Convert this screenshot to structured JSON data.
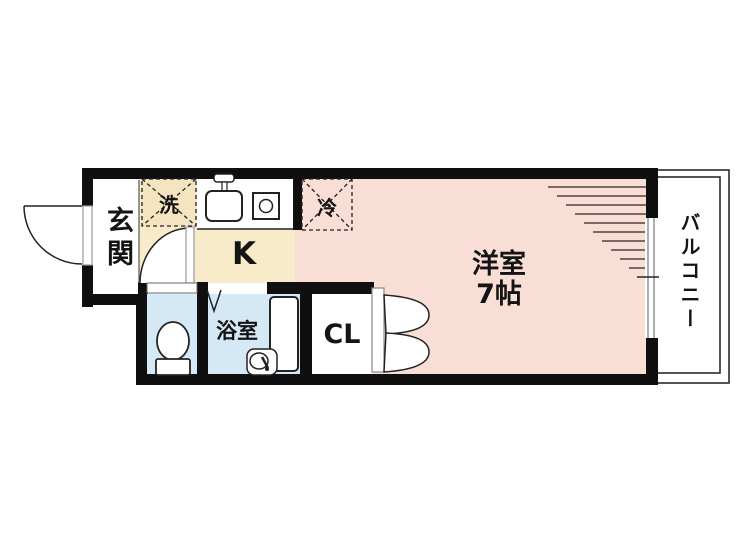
{
  "plan": {
    "type": "apartment-floor-plan",
    "rooms": {
      "genkan": {
        "label": "玄関"
      },
      "kitchen": {
        "label": "K"
      },
      "washer_box": {
        "label": "洗"
      },
      "fridge_box": {
        "label": "冷"
      },
      "bathroom": {
        "label": "浴室"
      },
      "western_room": {
        "label": "洋室",
        "size": "7帖"
      },
      "closet": {
        "label": "CL"
      },
      "balcony": {
        "label": "バルコニー"
      }
    },
    "icons": {
      "toilet": "toilet-icon",
      "bathtub": "bathtub-icon",
      "bath_faucet": "faucet-icon",
      "kitchen_sink": "sink-icon",
      "stove": "stove-burner-icon"
    },
    "colors": {
      "room_pink": "#f9ded5",
      "kitchen_cream": "#f8ebc9",
      "wet_blue": "#d5e8f6",
      "wall": "#0f0f0f",
      "hatch": "#7b6a63"
    }
  }
}
